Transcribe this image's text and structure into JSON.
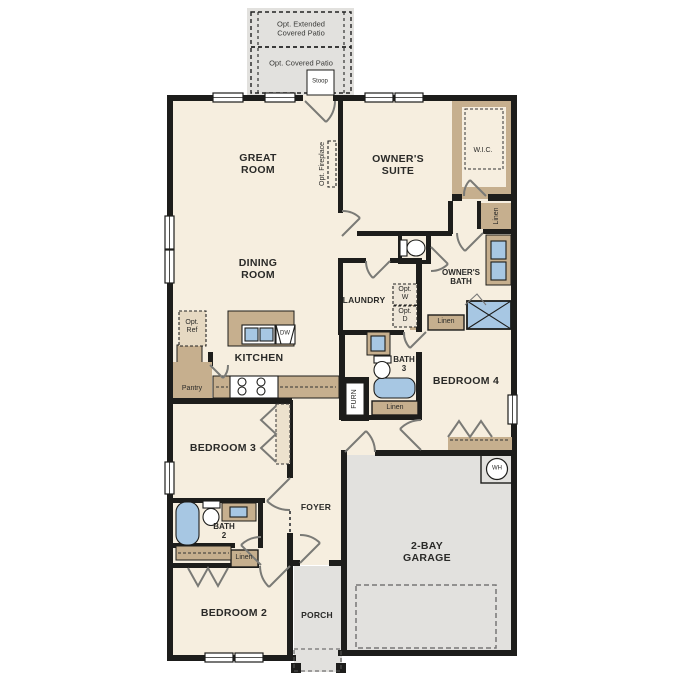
{
  "patio": {
    "extended_label": "Opt. Extended\nCovered Patio",
    "covered_label": "Opt. Covered Patio",
    "stoop_label": "Stoop"
  },
  "rooms": {
    "great_room": "GREAT\nROOM",
    "dining_room": "DINING\nROOM",
    "kitchen": "KITCHEN",
    "owners_suite": "OWNER'S\nSUITE",
    "wic": "W.I.C.",
    "owners_bath": "OWNER'S\nBATH",
    "laundry": "LAUNDRY",
    "bath3": "BATH\n3",
    "bedroom4": "BEDROOM 4",
    "bedroom3": "BEDROOM 3",
    "foyer": "FOYER",
    "bath2": "BATH\n2",
    "bedroom2": "BEDROOM 2",
    "porch": "PORCH",
    "garage": "2-BAY\nGARAGE"
  },
  "features": {
    "opt_fireplace": "Opt. Fireplace",
    "opt_ref": "Opt.\nRef",
    "opt_w": "Opt.\nW",
    "opt_d": "Opt.\nD",
    "pantry": "Pantry",
    "linen": "Linen",
    "furn": "FURN",
    "dw": "DW",
    "wh": "WH"
  },
  "colors": {
    "wall": "#1d1d1b",
    "floor": "#f6eedf",
    "outdoor": "#e2e1de",
    "cabinet": "#c6af8e",
    "fixture_blue": "#a7c7e3"
  }
}
